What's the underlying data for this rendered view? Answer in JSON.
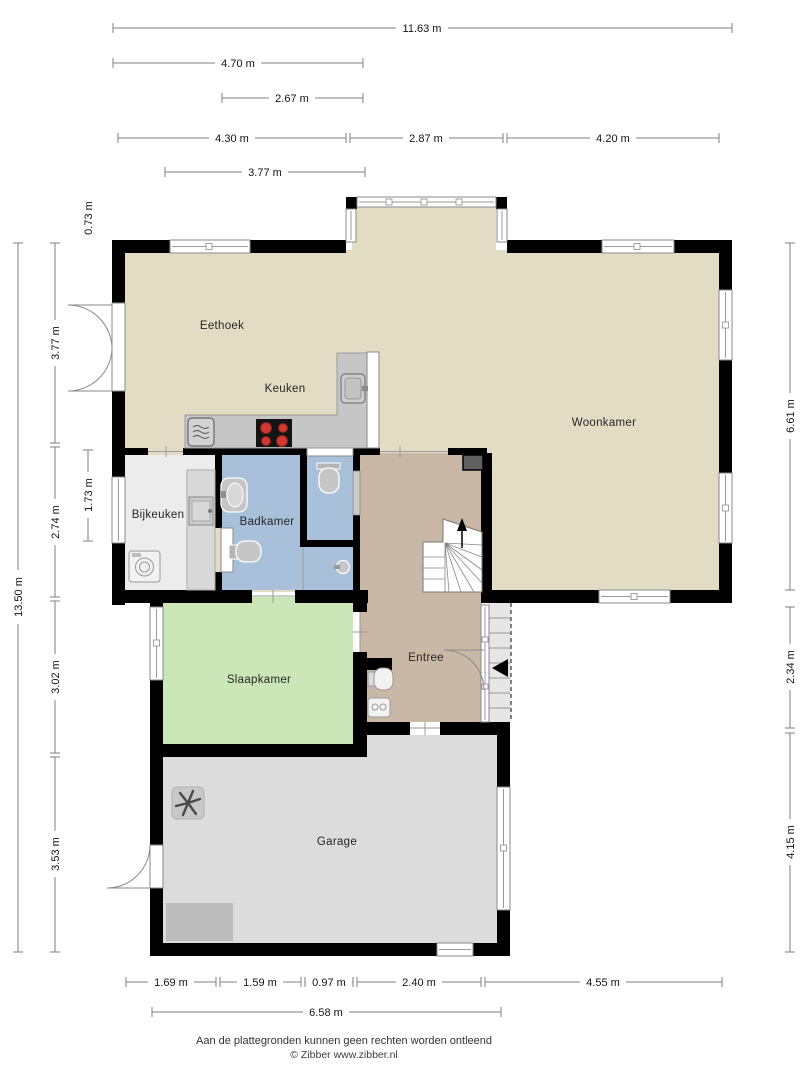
{
  "plan": {
    "title_hidden": "",
    "rooms": [
      {
        "id": "eethoek",
        "label": "Eethoek"
      },
      {
        "id": "keuken",
        "label": "Keuken"
      },
      {
        "id": "woonkamer",
        "label": "Woonkamer"
      },
      {
        "id": "bijkeuken",
        "label": "Bijkeuken"
      },
      {
        "id": "badkamer",
        "label": "Badkamer"
      },
      {
        "id": "entree",
        "label": "Entree"
      },
      {
        "id": "slaapkamer",
        "label": "Slaapkamer"
      },
      {
        "id": "garage",
        "label": "Garage"
      }
    ],
    "dimensions": {
      "top": [
        "11.63 m",
        "4.70 m",
        "2.67 m",
        "4.30 m",
        "2.87 m",
        "4.20 m",
        "3.77 m"
      ],
      "left": [
        "0.73 m",
        "3.77 m",
        "1.73 m",
        "2.74 m",
        "13.50 m",
        "3.02 m",
        "3.53 m"
      ],
      "right": [
        "6.61 m",
        "2.34 m",
        "4.15 m"
      ],
      "bottom": [
        "1.69 m",
        "1.59 m",
        "0.97 m",
        "2.40 m",
        "4.55 m",
        "6.58 m"
      ]
    },
    "colors": {
      "living": "#e3dcc4",
      "entree": "#c9b8a6",
      "bathroom": "#a9c0da",
      "utility": "#ececec",
      "bedroom": "#cbe7b8",
      "garage": "#dcdcdc",
      "porch": "#e6e6e6",
      "wall": "#000000",
      "stove_burner": "#cf3a30"
    },
    "footer": {
      "disclaimer": "Aan de plattegronden kunnen geen rechten worden ontleend",
      "copyright": "© Zibber www.zibber.nl"
    }
  }
}
